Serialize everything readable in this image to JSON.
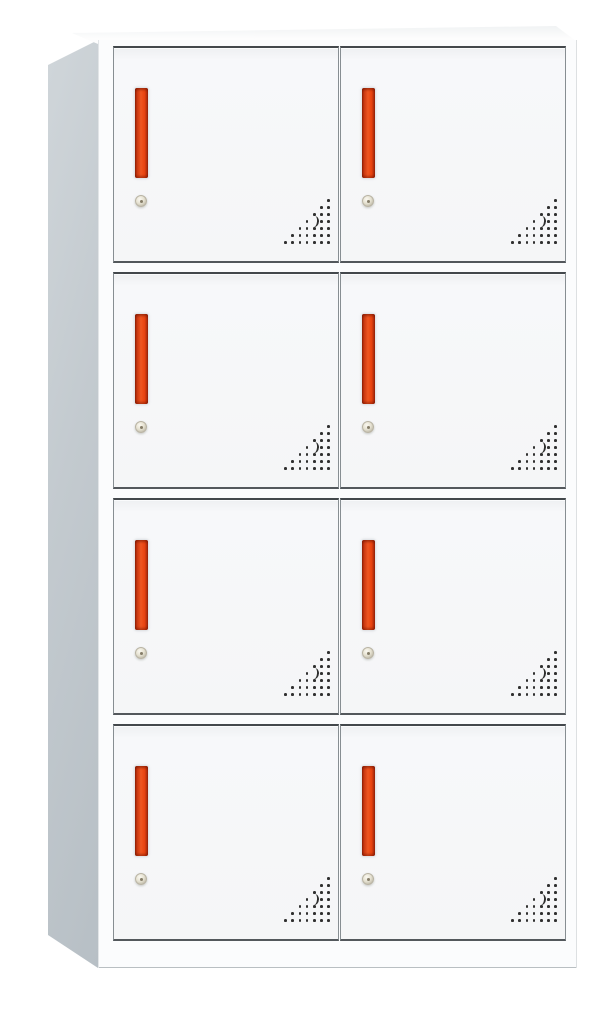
{
  "image": {
    "subject": "8-door metal locker cabinet product photo",
    "background_color": "#ffffff"
  },
  "cabinet": {
    "columns": 2,
    "rows": 4,
    "door_count": 8,
    "colors": {
      "frame_white": "#fbfcfd",
      "door_face": "#f5f6f7",
      "side_light": "#d0d6da",
      "side_dark": "#b7bfc5",
      "top_face": "#fdfdfd",
      "edge_dark": "#43484c",
      "edge_mid": "#878e92",
      "edge_bottom": "#53585c",
      "handle_red": "#e8430f",
      "handle_red_dark": "#96220a",
      "handle_red_light": "#ee5520",
      "lock_body": "#e6e2d2",
      "lock_rim": "#b9b4a4",
      "lock_center": "#857d69",
      "vent_dot": "#303030",
      "bottom_edge": "#b9bfc2"
    },
    "door": {
      "parts": [
        "door-handle",
        "cam-lock",
        "vent-holes"
      ],
      "vent_rows": [
        1,
        2,
        3,
        4,
        5,
        6,
        7
      ],
      "vent_crescent": {
        "row_index": 3,
        "col_from_right": 2
      }
    }
  }
}
